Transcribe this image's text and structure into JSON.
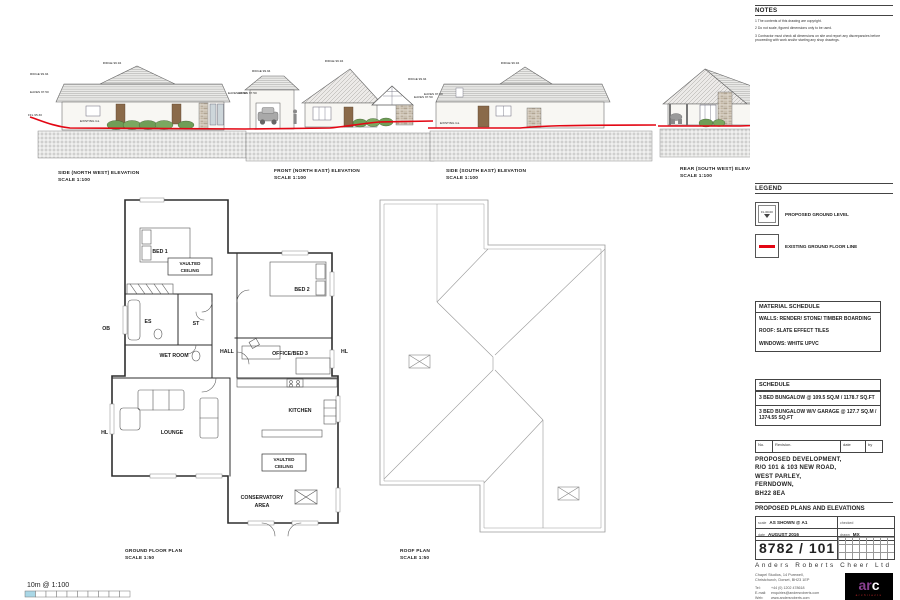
{
  "notes": {
    "title": "NOTES",
    "items": [
      "1 The contents of this drawing are copyright.",
      "2 Do not scale, figured dimensions only to be used.",
      "3 Contractor must check all dimensions on site and report any discrepancies before proceeding with work and/or starting any shop drawings."
    ]
  },
  "legend": {
    "title": "LEGEND",
    "proposed_symbol_text": "FL 00.00",
    "items": [
      {
        "label": "PROPOSED GROUND LEVEL"
      },
      {
        "label": "EXISTING GROUND FLOOR LINE"
      }
    ]
  },
  "material_schedule": {
    "title": "MATERIAL SCHEDULE",
    "lines": [
      "WALLS: RENDER/ STONE/ TIMBER BOARDING",
      "ROOF: SLATE EFFECT TILES",
      "WINDOWS: WHITE UPVC"
    ]
  },
  "schedule": {
    "title": "SCHEDULE",
    "rows": [
      "3 BED BUNGALOW @ 109.5 SQ.M / 1178.7 SQ.FT",
      "3 BED BUNGALOW W/V GARAGE @ 127.7 SQ.M / 1374.55 SQ.FT"
    ]
  },
  "revision_table": {
    "no": "No.",
    "revision": "Revision.",
    "date": "date",
    "by": "by"
  },
  "project": {
    "address": [
      "PROPOSED DEVELOPMENT,",
      "R/O 101 & 103 NEW ROAD,",
      "WEST PARLEY,",
      "FERNDOWN,",
      "BH22 8EA"
    ],
    "drawing_title": "PROPOSED PLANS AND ELEVATIONS"
  },
  "title_block": {
    "scale_label": "scale",
    "scale_value": "AS SHOWN @ A1",
    "checked_label": "checked",
    "date_label": "date",
    "date_value": "AUGUST 2016",
    "drawn_label": "drawn",
    "drawn_value": "MX",
    "drawing_number": "8782 / 101",
    "company": "Anders Roberts Cheer Ltd",
    "address_line1": "Chapel Studios, 14 Purewell,",
    "address_line2": "Christchurch, Dorset, BH23 1EP",
    "tel_label": "Tel:",
    "tel_value": "+44 (0) 1202 478618",
    "email_label": "E-mail:",
    "email_value": "enquiries@andersroberts.com",
    "web_label": "Web:",
    "web_value": "www.andersroberts.com",
    "logo_ar": "ar",
    "logo_c": "c",
    "logo_sub": "architects"
  },
  "elevations": [
    {
      "title": "SIDE (NORTH WEST) ELEVATION",
      "scale": "SCALE 1:100"
    },
    {
      "title": "FRONT (NORTH EAST) ELEVATION",
      "scale": "SCALE 1:100"
    },
    {
      "title": "SIDE (SOUTH EAST) ELEVATION",
      "scale": "SCALE 1:100"
    },
    {
      "title": "REAR (SOUTH WEST) ELEVATION",
      "scale": "SCALE 1:100"
    }
  ],
  "levels": {
    "ridge": "RIDGE 99.94",
    "eaves": "EAVES 97.50",
    "ffl": "FFL 95.30",
    "gl": "EXISTING GL"
  },
  "floor_plan": {
    "caption": "GROUND FLOOR PLAN",
    "scale": "SCALE 1:50",
    "rooms": {
      "bed1": "BED 1",
      "vaulted_l1": "VAULTED",
      "vaulted_l2": "CEILING",
      "es": "ES",
      "st": "ST",
      "ob": "OB",
      "wet_room": "WET ROOM",
      "hall": "HALL",
      "bed2": "BED 2",
      "office": "OFFICE/BED 3",
      "hl": "HL",
      "lounge": "LOUNGE",
      "kitchen": "KITCHEN",
      "conservatory_l1": "CONSERVATORY",
      "conservatory_l2": "AREA"
    }
  },
  "roof_plan": {
    "caption": "ROOF PLAN",
    "scale": "SCALE 1:50"
  },
  "scale_bar": {
    "label": "10m @ 1:100"
  },
  "colors": {
    "existing_line": "#e30613",
    "scale_fill": "#a9d7e6"
  }
}
